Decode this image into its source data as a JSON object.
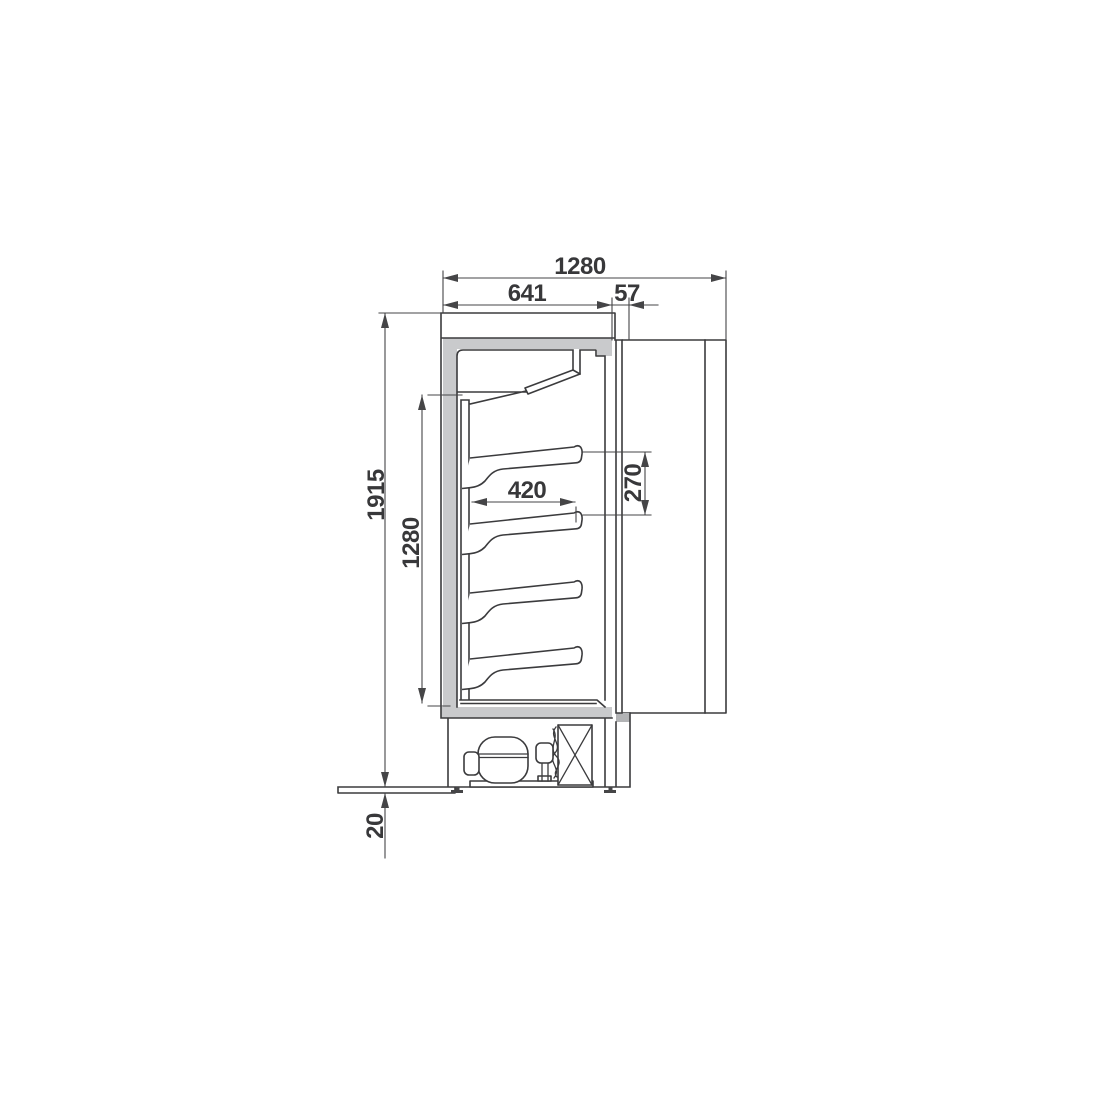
{
  "drawing": {
    "dimensions": {
      "overall_depth": "1280",
      "body_depth": "641",
      "front_offset": "57",
      "overall_height": "1915",
      "opening_height": "1280",
      "shelf_depth": "420",
      "shelf_spacing": "270",
      "base_plate_thickness": "20"
    },
    "colors": {
      "line": "#3b3b3d",
      "dim": "#454547",
      "gray": "#c9cacc",
      "gray2": "#b2b3b5",
      "text": "#38383a",
      "bg": "#ffffff"
    }
  }
}
